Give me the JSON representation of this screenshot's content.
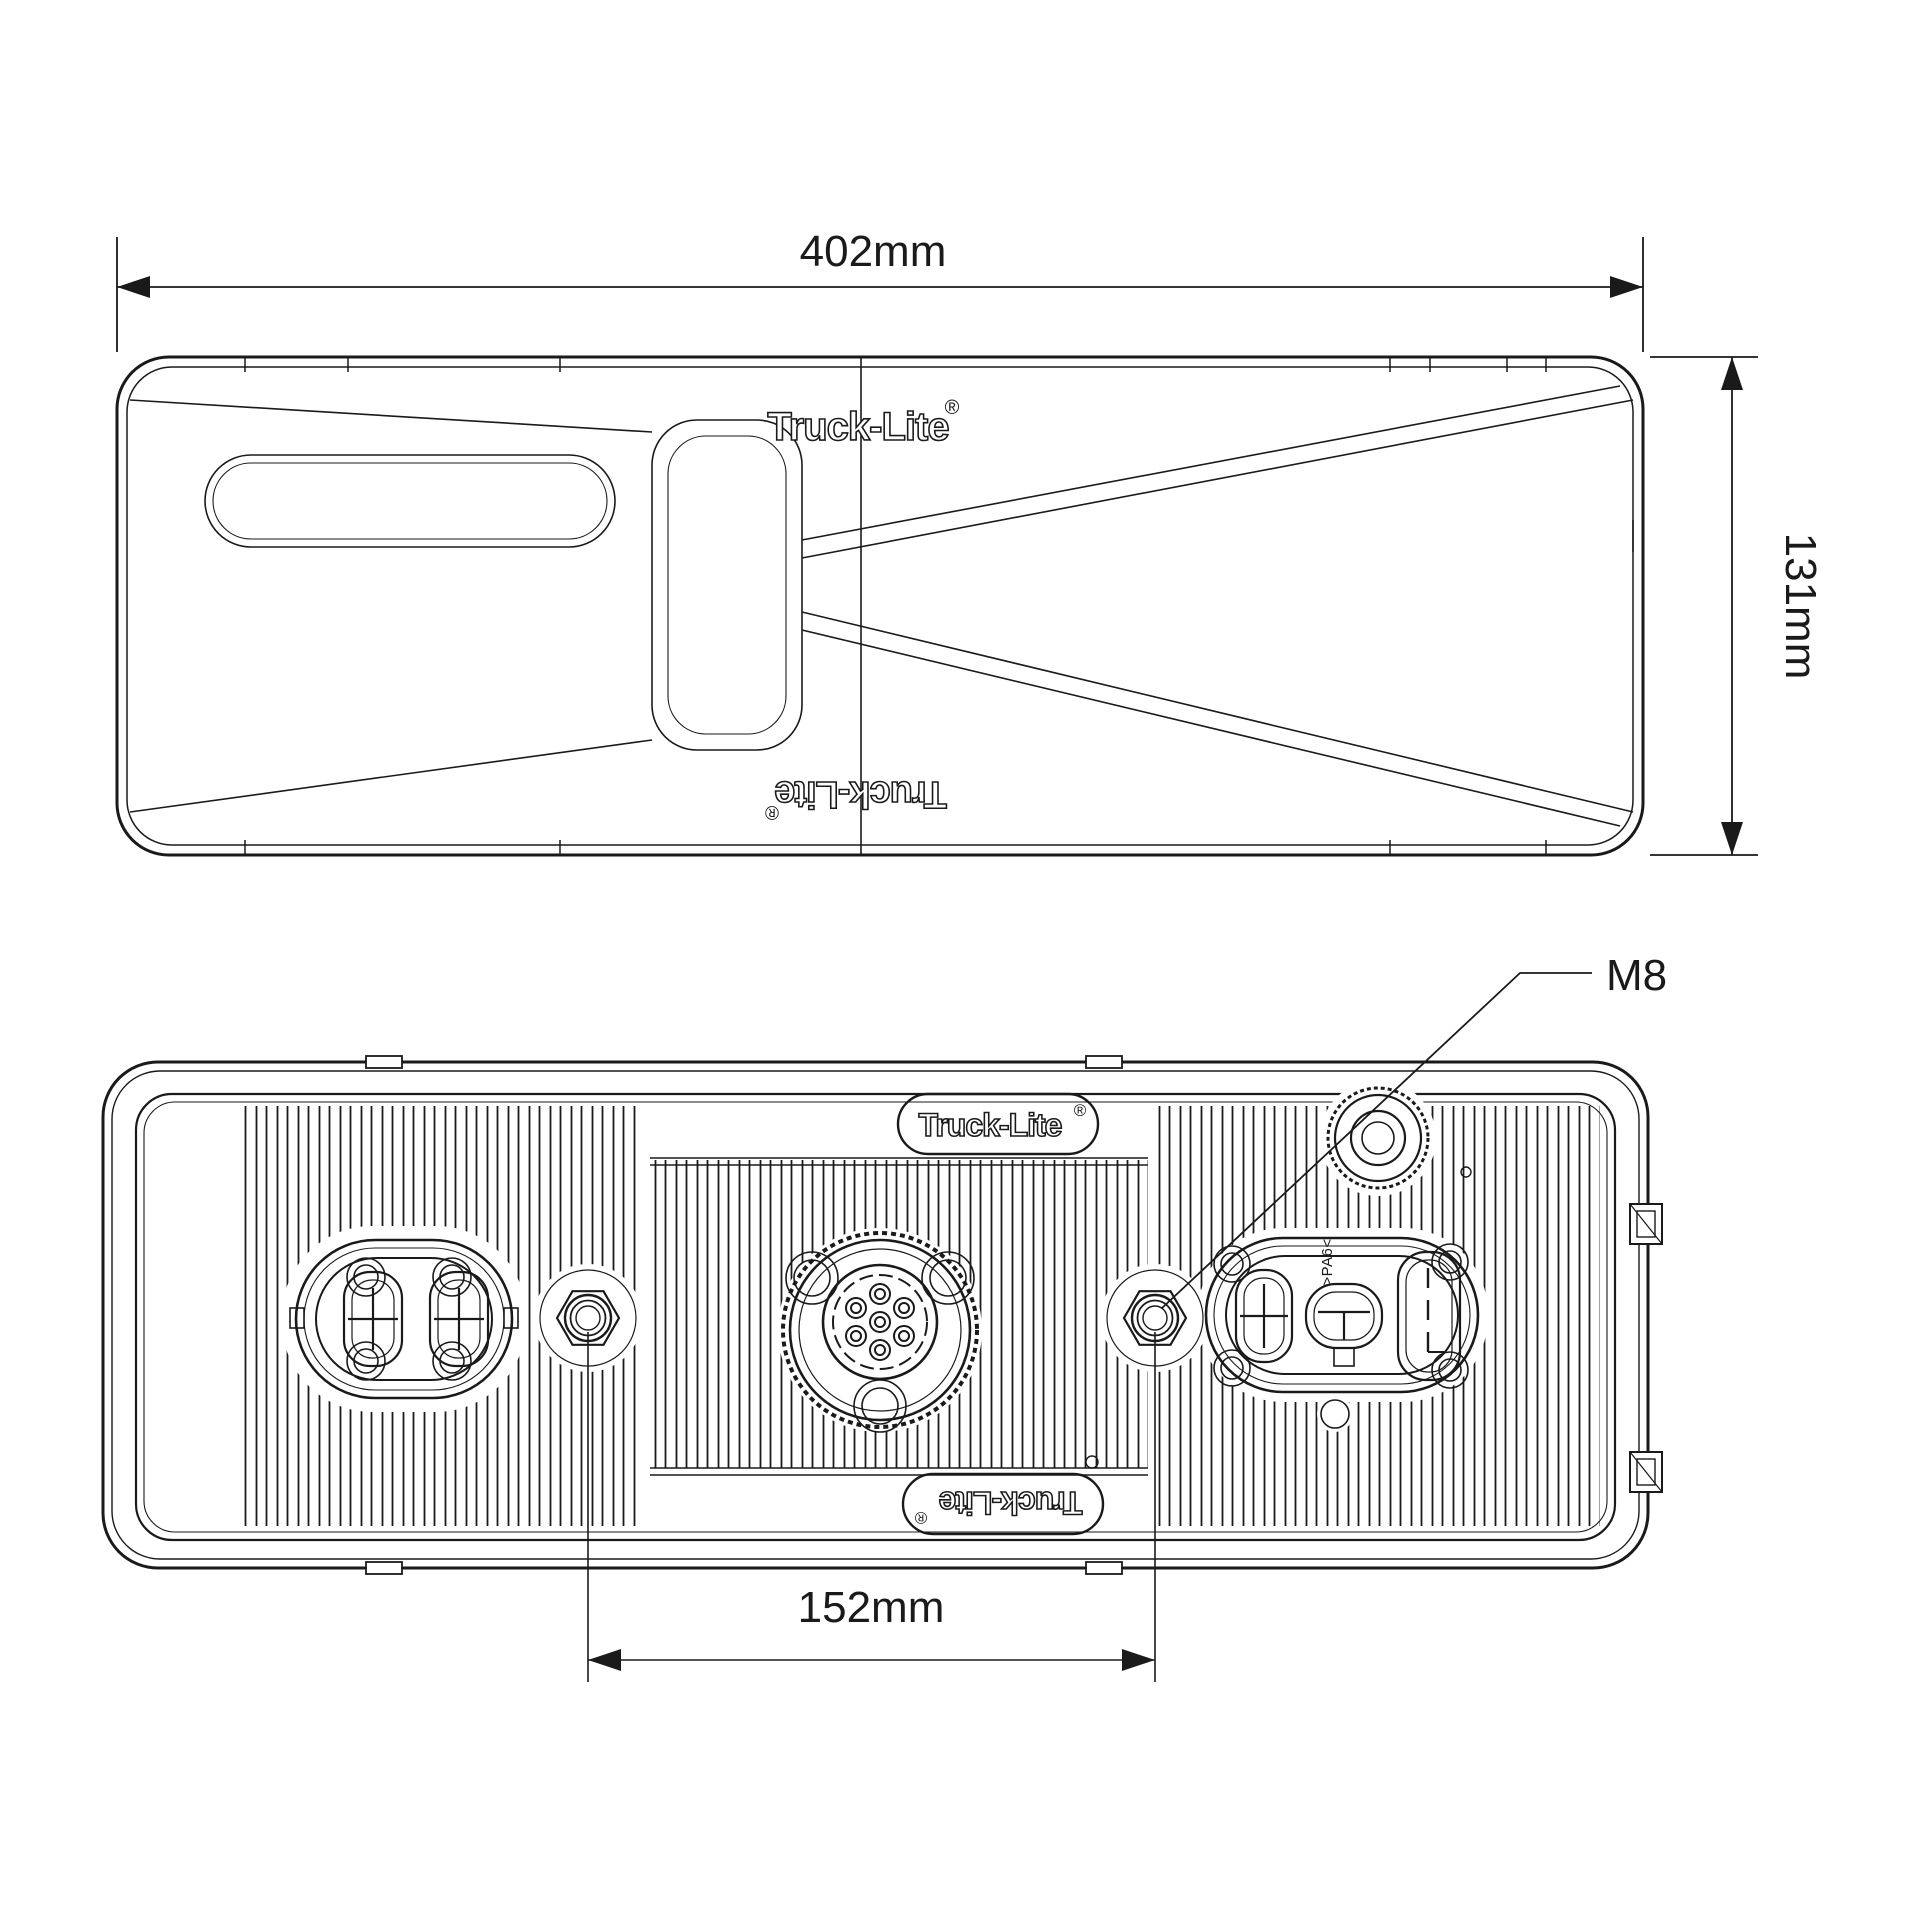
{
  "colors": {
    "line": "#1a1a1a",
    "background": "#ffffff"
  },
  "brand": {
    "name": "Truck-Lite",
    "registered_mark": "®"
  },
  "top_view": {
    "width_dim": "402mm",
    "height_dim": "131mm",
    "logo_upper": "Truck-Lite",
    "logo_lower": "Truck-Lite"
  },
  "back_view": {
    "stud_spacing_dim": "152mm",
    "stud_callout": "M8",
    "material_marking": ">PA6<",
    "badge_upper": "Truck-Lite",
    "badge_lower": "Truck-Lite"
  }
}
